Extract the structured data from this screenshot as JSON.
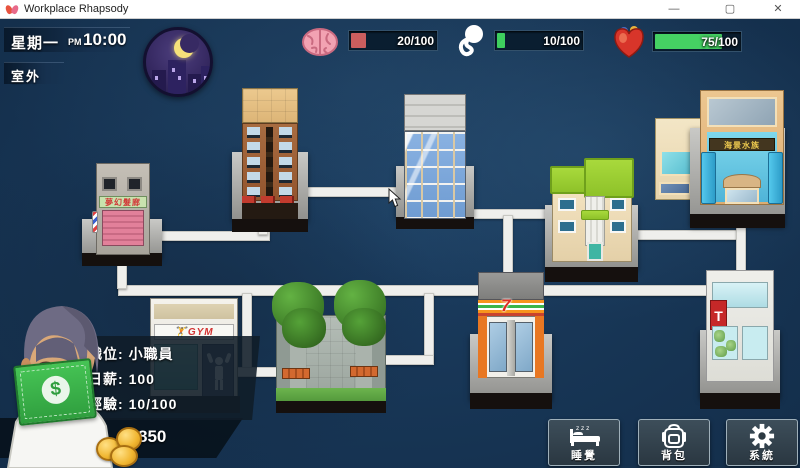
{
  "window": {
    "title": "Workplace Rhapsody",
    "minimize": "—",
    "maximize": "▢",
    "close": "✕"
  },
  "hud": {
    "day": "星期一",
    "meridiem": "PM",
    "time": "10:00",
    "location": "室外",
    "stats": [
      {
        "id": "brain",
        "label": "20/100",
        "value": 20,
        "max": 100,
        "color": "#cb5e5e",
        "fill_style": "width:17%;background:#cb5e5e"
      },
      {
        "id": "spirit",
        "label": "10/100",
        "value": 10,
        "max": 100,
        "color": "#3ecf5e",
        "fill_style": "width:9%;background:#3ecf5e"
      },
      {
        "id": "health",
        "label": "75/100",
        "value": 75,
        "max": 100,
        "color": "#45d163",
        "fill_style": "width:76%;background:#45d163"
      }
    ]
  },
  "map": {
    "signs": {
      "barbershop": "夢幻髮廊",
      "restaurant": "海景水族",
      "convenience": "7",
      "gym": "GYM",
      "pharmacy": "T"
    }
  },
  "player": {
    "rows": [
      {
        "label": "職位:",
        "value": "小職員"
      },
      {
        "label": "日薪:",
        "value": "100"
      },
      {
        "label": "經驗:",
        "value": "10/100"
      }
    ],
    "money": "850",
    "currency_symbol": "$"
  },
  "actions": [
    {
      "id": "sleep",
      "label": "睡覺"
    },
    {
      "id": "bag",
      "label": "背包"
    },
    {
      "id": "system",
      "label": "系統"
    }
  ]
}
